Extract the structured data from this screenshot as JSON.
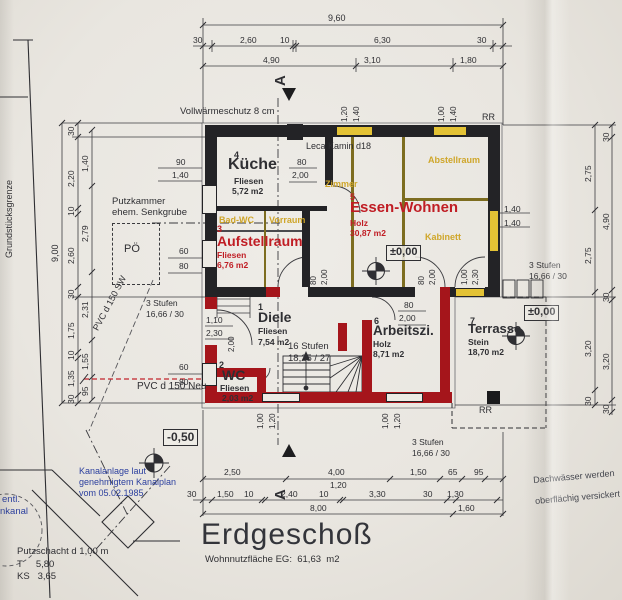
{
  "page": {
    "title": "Erdgeschoß",
    "subtitle": "Wohnnutzfläche EG:  61,63  m2"
  },
  "section_marker": "A",
  "envelope_note": "Vollwärmeschutz 8 cm",
  "kamin_note": "Leca Kamin d18",
  "rr": "RR",
  "levels": {
    "zero": "±0,00",
    "minus": "-0,50"
  },
  "rooms": {
    "diele": {
      "num": "1",
      "name": "Diele",
      "mat": "Fliesen",
      "area": "7,54 m2"
    },
    "wc": {
      "num": "2",
      "name": "WC",
      "mat": "Fliesen",
      "area": "2,03 m2"
    },
    "aufstellraum": {
      "num": "3",
      "name": "Aufstellraum",
      "mat": "Fliesen",
      "area": "6,76 m2"
    },
    "kueche": {
      "num": "4",
      "name": "Küche",
      "mat": "Fliesen",
      "area": "5,72 m2"
    },
    "essen": {
      "num": "5",
      "name": "Essen-Wohnen",
      "mat": "Holz",
      "area": "30,87 m2"
    },
    "arbeitszimmer": {
      "num": "6",
      "name": "Arbeitszi.",
      "mat": "Holz",
      "area": "8,71 m2"
    },
    "terrasse": {
      "num": "7",
      "name": "Terrasse",
      "mat": "Stein",
      "area": "18,70 m2"
    }
  },
  "old_rooms": {
    "zimmer": "Zimmer",
    "abstellraum": "Abstellraum",
    "kabinett": "Kabinett",
    "badwc": "Bad-WC",
    "vorraum": "Vorraum"
  },
  "stairs": {
    "main_l1": "16 Stufen",
    "main_l2": "18,25 / 27",
    "s3_l1": "3 Stufen",
    "s3_l2": "16,66 / 30"
  },
  "site": {
    "grenze": "Grundstücksgrenze",
    "putzkammer_l1": "Putzkammer",
    "putzkammer_l2": "ehem. Senkgrube",
    "poe": "PÖ",
    "pvc_sw": "PVC d 150 SW",
    "pvc_neu": "PVC d 150 Neu",
    "kanal_l1": "Kanalanlage laut",
    "kanal_l2": "genehmigtem Kanalplan",
    "kanal_l3": "vom 05.02.1985",
    "kanal_frag_l1": "entl.",
    "kanal_frag_l2": "nkanal",
    "putzschacht_l1": "Putzschacht d 1,00 m",
    "putzschacht_l2": "T     5,80",
    "putzschacht_l3": "KS   3,65",
    "dach_l1": "Dachwässer werden",
    "dach_l2": "oberflächig versickert"
  },
  "dims": {
    "top1": "9,60",
    "top2": [
      "30",
      "2,60",
      "10",
      "6,30",
      "30"
    ],
    "top3": [
      "4,90",
      "3,10",
      "1,80"
    ],
    "left_total": "9,00",
    "left_outer": [
      "30",
      "2,20",
      "10",
      "2,60",
      "30",
      "1,75",
      "10",
      "1,35",
      "30"
    ],
    "left_inner": [
      "1,40",
      "2,79",
      "2,31",
      "1,55",
      "95"
    ],
    "right_inner": [
      "2,75",
      "2,75",
      "3,20",
      "30"
    ],
    "right_outer": [
      "30",
      "4,90",
      "30",
      "3,20",
      "30"
    ],
    "bottom1": [
      "2,50",
      "4,00",
      "1,50",
      "65",
      "95"
    ],
    "bottom1_sub": "1,20",
    "bottom2": [
      "30",
      "1,50",
      "10",
      "2,40",
      "10",
      "3,30",
      "30",
      "1,30"
    ],
    "bottom3": [
      "8,00",
      "1,60"
    ],
    "win_top1": [
      "1,20",
      "1,40"
    ],
    "win_top2": [
      "1,00",
      "1,40"
    ],
    "win_right": [
      "1,40",
      "1,40"
    ],
    "win_kueche": [
      "90",
      "1,40"
    ],
    "win_aufstell": [
      "60",
      "80"
    ],
    "win_wc": [
      "60",
      "80"
    ],
    "win_bottom1": [
      "1,00",
      "1,20"
    ],
    "win_bottom2": [
      "1,00",
      "1,20"
    ],
    "door_kueche": [
      "80",
      "2,00"
    ],
    "door_diele1": [
      "80",
      "2,00"
    ],
    "door_diele2": [
      "80",
      "2,00"
    ],
    "door_arbeit": [
      "80",
      "2,00"
    ],
    "door_terrasse": [
      "1,00",
      "2,30"
    ],
    "door_entry": [
      "1,10",
      "2,30"
    ],
    "door_entry_h": "2,00"
  },
  "colors": {
    "red_wall": "#a5151b",
    "red_text": "#c01d24",
    "window_yellow": "#e3c235",
    "old_wall_olive": "#7d6d20",
    "note_blue": "#2b3f9e",
    "paper": "#e9e6e0"
  }
}
